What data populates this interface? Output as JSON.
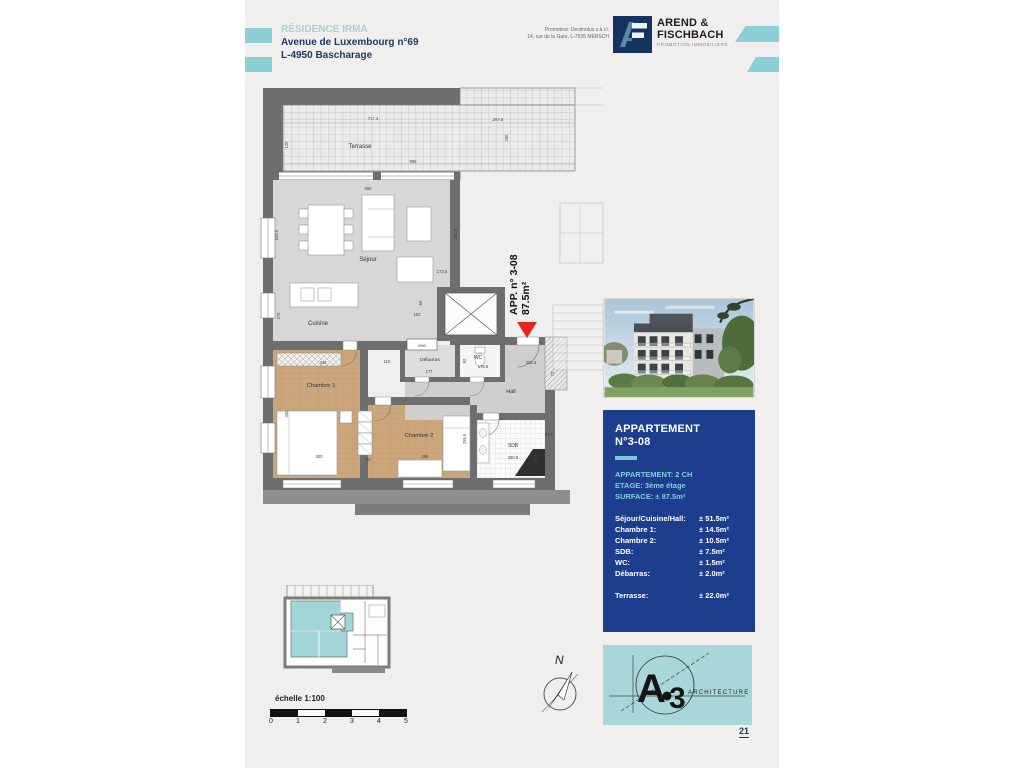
{
  "header": {
    "residence": "RÉSIDENCE IRMA",
    "address_line1": "Avenue de Luxembourg n°69",
    "address_line2": "L-4950 Bascharage",
    "promoter_line1": "Promoteur: Devimolux s.à r.l.",
    "promoter_line2": "14, rue de la Gare, L-7535 MERSCH",
    "logo": {
      "name_line1": "AREND &",
      "name_line2": "FISCHBACH",
      "tagline": "PROMOTION IMMOBILIÈRE"
    }
  },
  "plan": {
    "rooms": [
      "Terrasse",
      "Séjour",
      "Cuisine",
      "Chambre 1",
      "Chambre 2",
      "VMC",
      "Débarras",
      "WC",
      "Hall",
      "SDB"
    ],
    "unit": {
      "line1": "APP. n° 3-08",
      "line2": "87.5m²"
    },
    "dims": [
      "717.4",
      "267.5",
      "985",
      "120",
      "250",
      "680",
      "548.5",
      "270",
      "352.5",
      "173.5",
      "103",
      "60",
      "342",
      "110",
      "177",
      "92",
      "176.5",
      "450",
      "300",
      "92",
      "369",
      "255.5",
      "206.5",
      "73",
      "260.5",
      "250.5",
      "81.5"
    ]
  },
  "sidebar": {
    "panel": {
      "title_line1": "APPARTEMENT",
      "title_line2": "N°3-08",
      "meta": [
        {
          "text": "APPARTEMENT: 2 CH"
        },
        {
          "text": "ETAGE: 3ème étage"
        },
        {
          "text": "SURFACE: ± 87.5m²"
        }
      ],
      "rows": [
        {
          "label": "Séjour/Cuisine/Hall:",
          "value": "± 51.5m²"
        },
        {
          "label": "Chambre 1:",
          "value": "± 14.5m²"
        },
        {
          "label": "Chambre 2:",
          "value": "± 10.5m²"
        },
        {
          "label": "SDB:",
          "value": "± 7.5m²"
        },
        {
          "label": "WC:",
          "value": "± 1.5m²"
        },
        {
          "label": "Débarras:",
          "value": "± 2.0m²"
        }
      ],
      "terrace_row": {
        "label": "Terrasse:",
        "value": "± 22.0m²"
      }
    },
    "architect": {
      "mark": "A",
      "digit": "3",
      "label": "ARCHITECTURE"
    }
  },
  "footer": {
    "scale_label": "échelle 1:100",
    "scale_ticks": [
      "0",
      "1",
      "2",
      "3",
      "4",
      "5"
    ],
    "north": "N",
    "page_number": "21"
  },
  "colors": {
    "accent_teal": "#8ccfd5",
    "panel_navy": "#1d3e8f",
    "panel_teal_text": "#7ecfdb",
    "arrow_red": "#e8251c",
    "wall_gray": "#6e6e6e",
    "wood": "#cba67b"
  }
}
